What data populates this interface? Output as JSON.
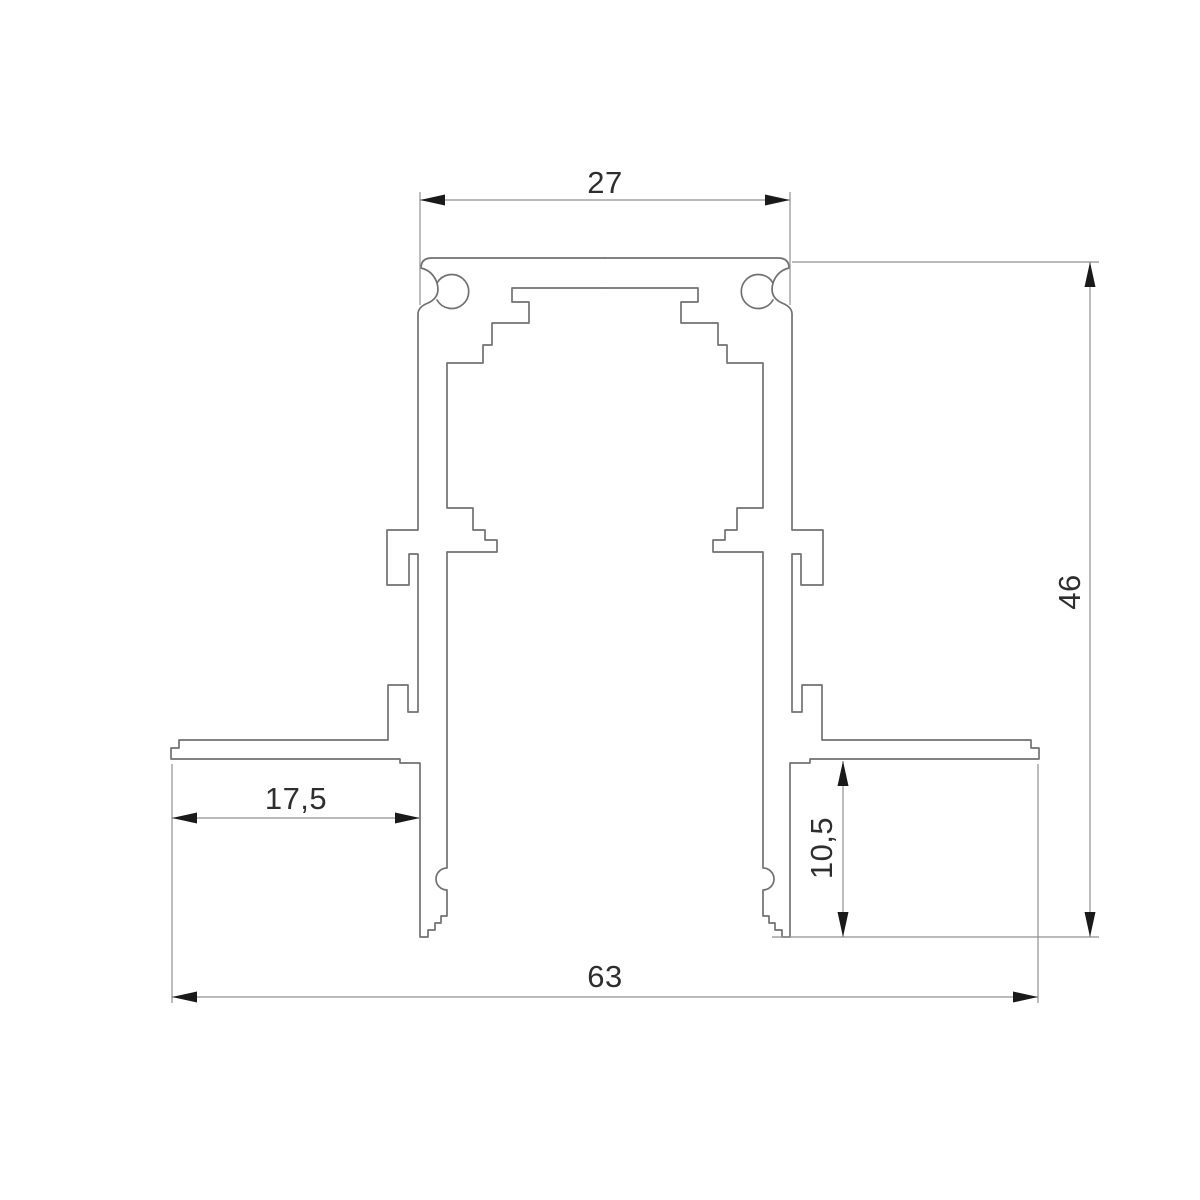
{
  "drawing": {
    "dimensions": {
      "top_width": "27",
      "overall_height": "46",
      "left_flange_width": "17,5",
      "right_flange_height": "10,5",
      "overall_width": "63"
    },
    "colors": {
      "background": "#ffffff",
      "profile_line": "#6f7173",
      "dimension_line": "#8f9193",
      "dimension_text": "#2e2e30",
      "arrowhead": "#1a1a1a"
    }
  }
}
